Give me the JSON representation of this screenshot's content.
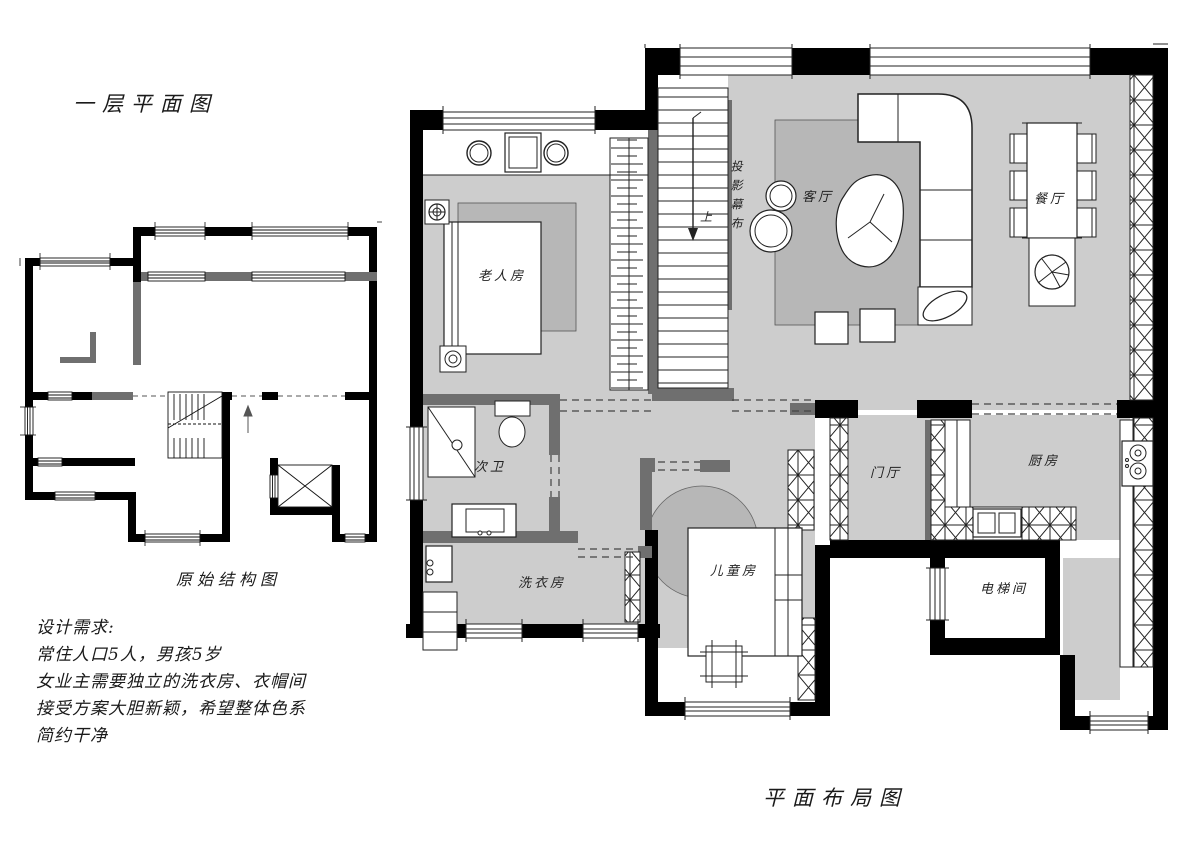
{
  "titles": {
    "floor_plan": "一层平面图",
    "original_structure": "原始结构图",
    "layout_plan": "平面布局图"
  },
  "requirements": {
    "heading": "设计需求:",
    "lines": [
      "常住人口5人，男孩5岁",
      "女业主需要独立的洗衣房、衣帽间",
      "接受方案大胆新颖，希望整体色系",
      "简约干净"
    ]
  },
  "rooms": {
    "elder_room": "老人房",
    "living_room": "客厅",
    "projection_screen": "投影幕布",
    "dining_room": "餐厅",
    "second_bath": "次卫",
    "laundry": "洗衣房",
    "children_room": "儿童房",
    "entry_hall": "门厅",
    "kitchen": "厨房",
    "elevator_room": "电梯间",
    "stair_up": "上"
  },
  "colors": {
    "wall_black": "#000000",
    "wall_gray": "#6f6f6f",
    "floor_gray": "#cdcdcd",
    "rug_gray": "#b7b7b7",
    "line": "#222222",
    "background": "#ffffff"
  }
}
